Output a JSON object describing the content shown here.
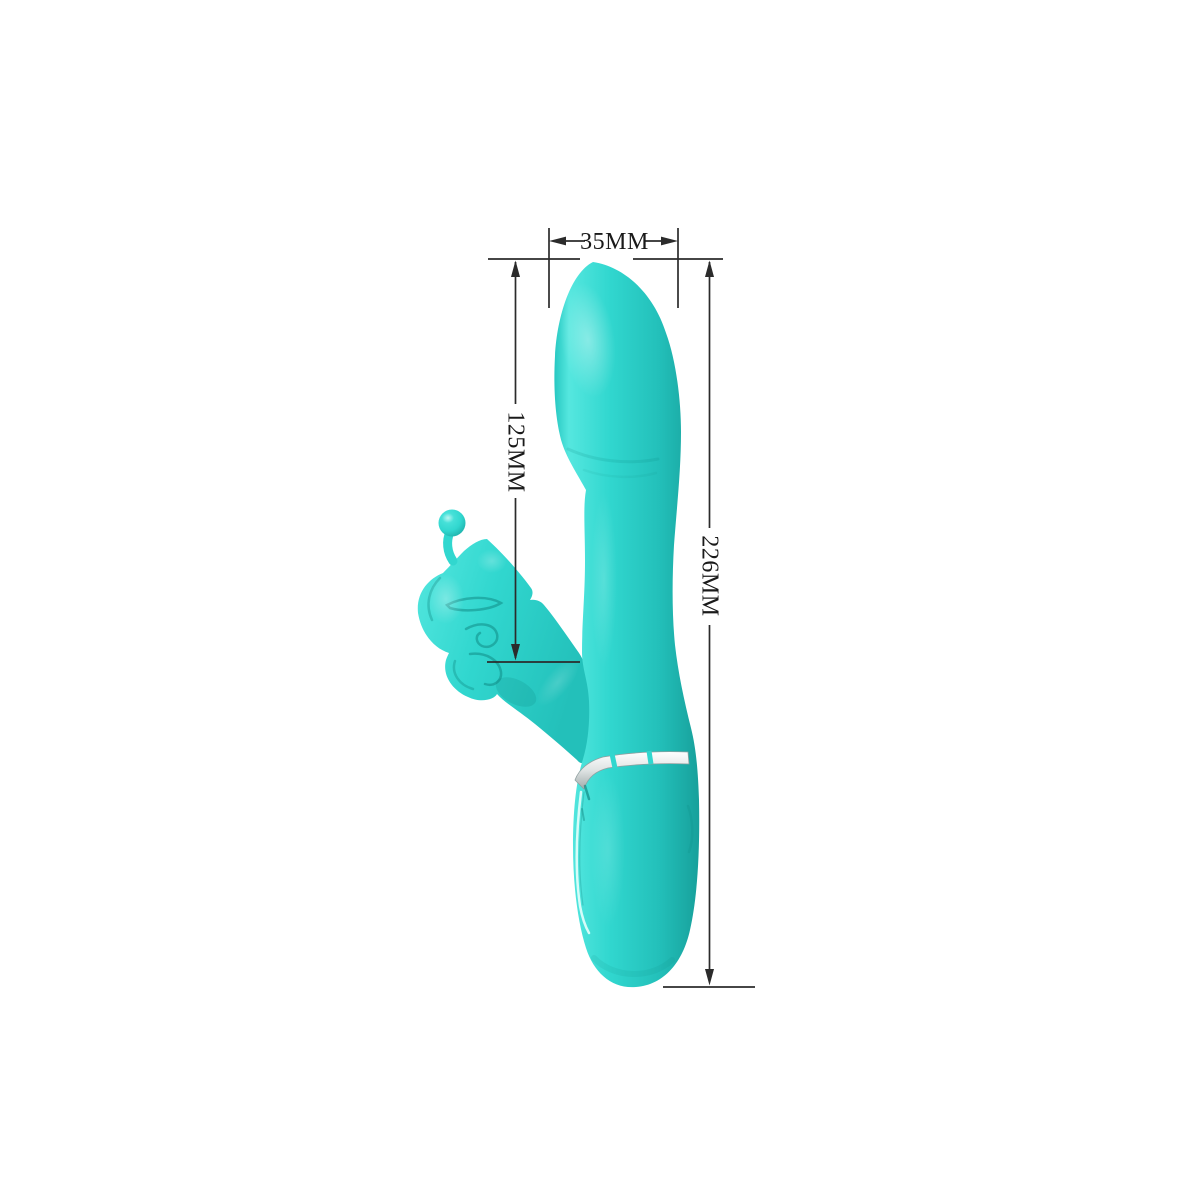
{
  "page": {
    "background": "#ffffff",
    "description": "Product dimension diagram: turquoise rabbit-style massager with butterfly attachment and measurement callouts"
  },
  "dimensions": {
    "width_label": "35MM",
    "inner_length_label": "125MM",
    "total_length_label": "226MM"
  },
  "colors": {
    "dimension_line": "#2b2b2b",
    "dimension_text": "#1a1a1a",
    "body_edge": "#27c8c2",
    "body_light": "#55e7df",
    "body_mid": "#31d7cf",
    "body_dark": "#23c0ba",
    "body_deep": "#17a09b",
    "band_light": "#ffffff",
    "band_mid": "#dfe3e3",
    "band_dark": "#a2abab",
    "detail_shadow": "#0a7d78"
  }
}
